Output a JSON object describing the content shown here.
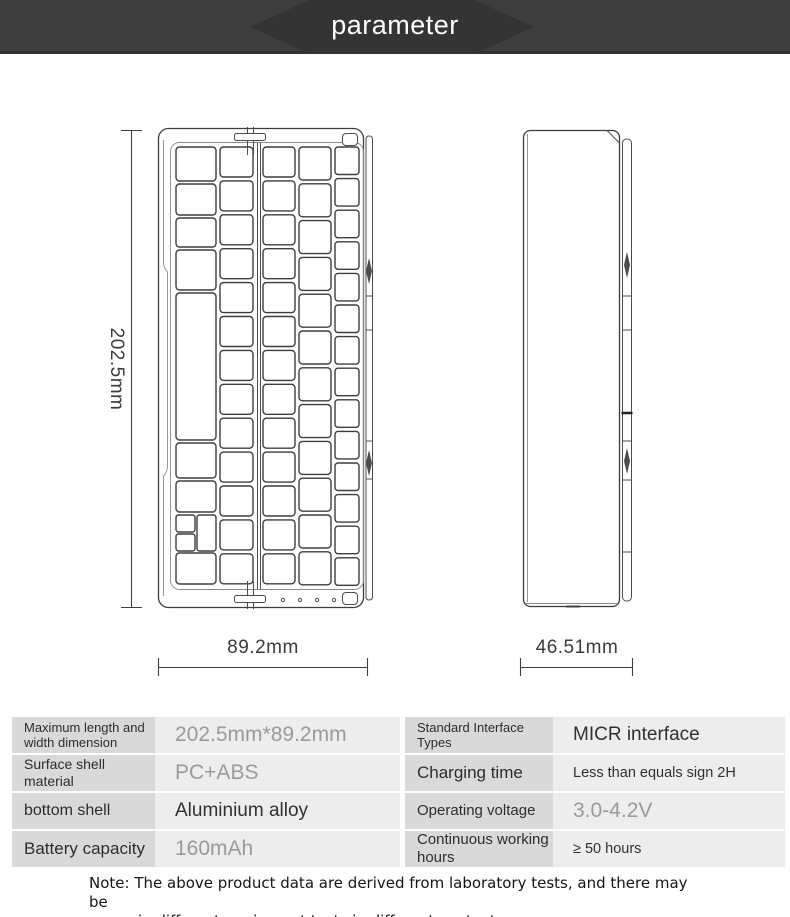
{
  "header": {
    "title": "parameter"
  },
  "colors": {
    "header_bar": "#3e3e3e",
    "header_hex": "#343434",
    "label_cell": "#d9d9d9",
    "value_cell": "#ededed",
    "value_gray": "#9a9a9a",
    "value_dark": "#303030"
  },
  "diagram": {
    "front_view": {
      "height_label": "202.5mm",
      "width_label": "89.2mm"
    },
    "side_view": {
      "width_label": "46.51mm"
    }
  },
  "spec_table": {
    "rows": [
      {
        "left_label": "Maximum length and width dimension",
        "left_value": "202.5mm*89.2mm",
        "right_label": "Standard Interface Types",
        "right_value": "MICR interface"
      },
      {
        "left_label": "Surface shell material",
        "left_value": "PC+ABS",
        "right_label": "Charging time",
        "right_value": "Less than equals sign 2H"
      },
      {
        "left_label": "bottom shell",
        "left_value": "Aluminium alloy",
        "right_label": "Operating voltage",
        "right_value": "3.0-4.2V"
      },
      {
        "left_label": "Battery capacity",
        "left_value": "160mAh",
        "right_label": "Continuous working hours",
        "right_value": "≥ 50 hours"
      }
    ]
  },
  "note": {
    "text": "Note: The above product data are derived from laboratory tests, and there may be\nerrors in different equipment tests in different contexts."
  }
}
